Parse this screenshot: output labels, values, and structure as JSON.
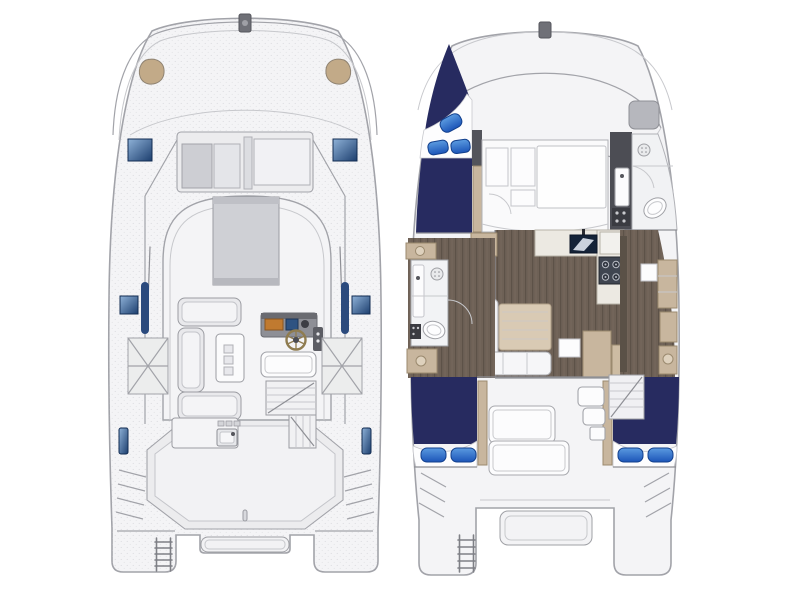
{
  "colors": {
    "background": "#ffffff",
    "hull_fill": "#f4f4f6",
    "hull_stroke": "#a2a3a9",
    "deck_panel": "#ececee",
    "sunroof_gray": "#cfd0d5",
    "bed_navy": "#272b60",
    "pillow_blue_light": "#5b9be0",
    "pillow_blue_dark": "#1c55b8",
    "hatch_blue_light": "#8fb2d8",
    "hatch_blue_dark": "#1c3e6e",
    "side_window_navy": "#2b4a7d",
    "wood_floor": "#6e6156",
    "wood_table": "#d9cab4",
    "cabinet_tan": "#c8b69e",
    "counter_cream": "#ece9e2",
    "appliance_dark": "#3f4550",
    "tv_screen": "#152338",
    "helm_display_orange": "#c07a30",
    "helm_display_blue": "#2f5382",
    "wall_dark": "#53545b",
    "seat_tan": "#c2aa88",
    "wheel_rim": "#8f7c50"
  }
}
